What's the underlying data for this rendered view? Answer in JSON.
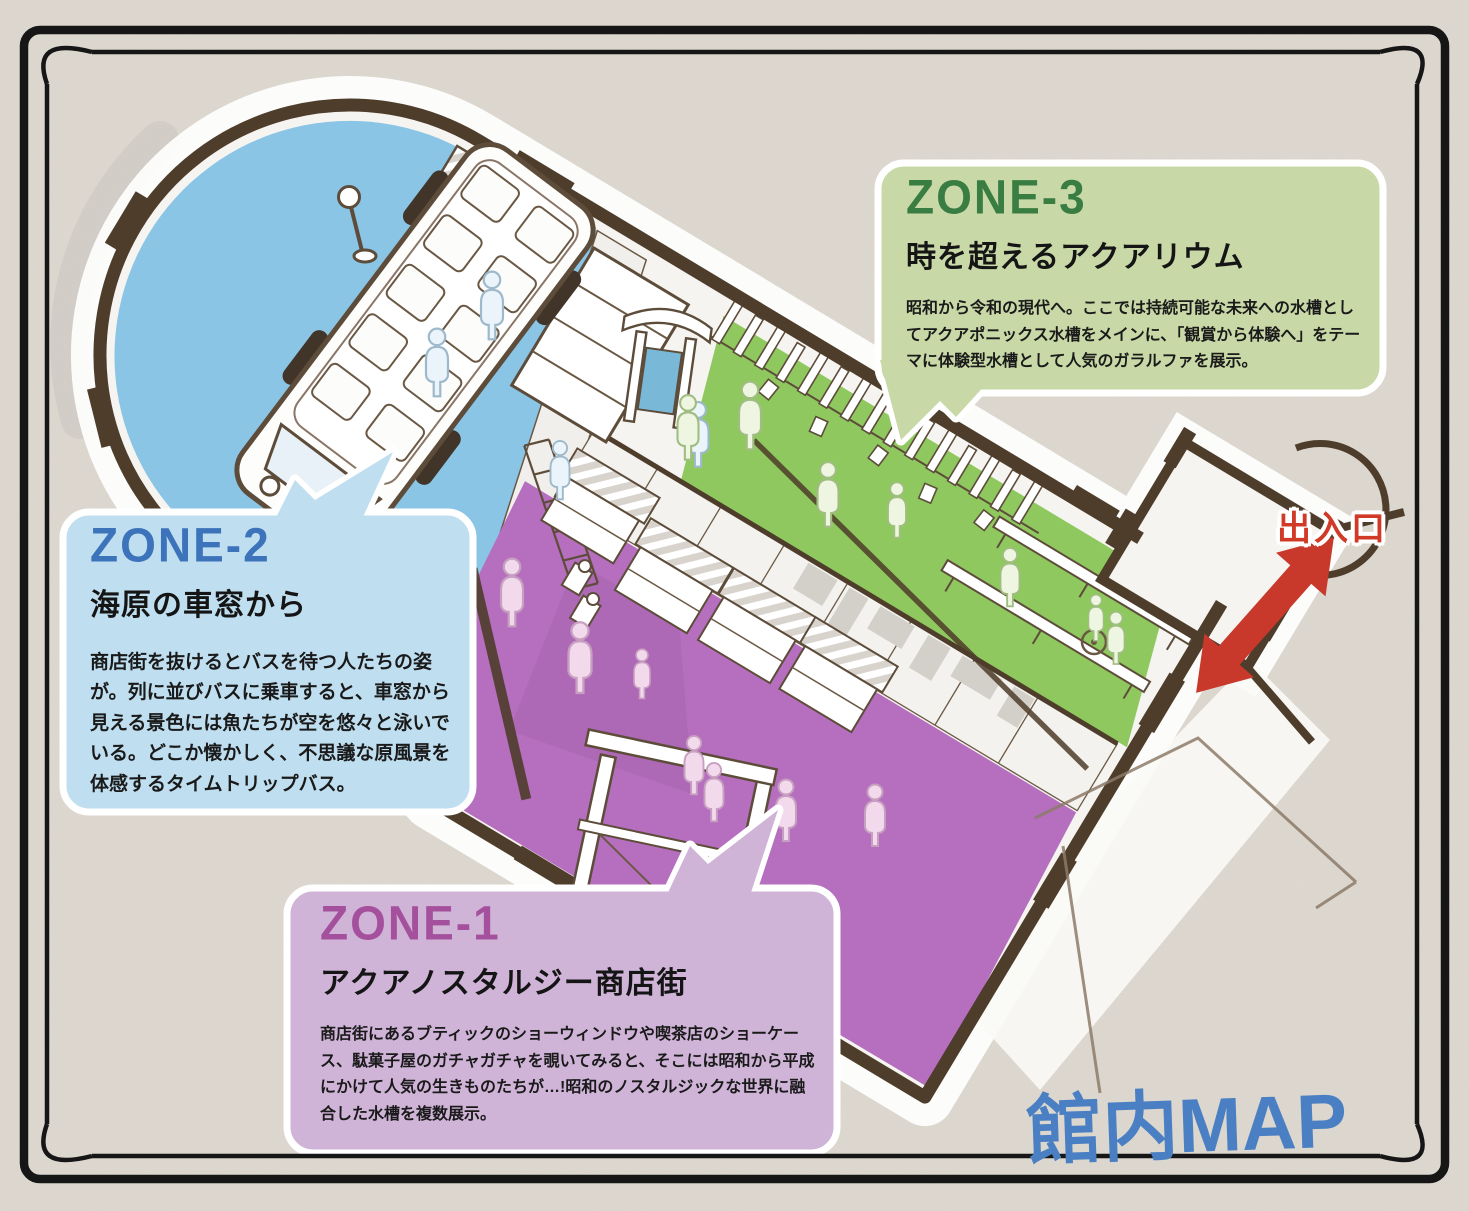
{
  "page": {
    "title_logo": "館内MAP",
    "logo_color": "#4a80c3",
    "background_color": "#ded9d1",
    "frame_color": "#161616"
  },
  "map": {
    "entrance_label": "出入口",
    "entrance_label_color": "#d03a26",
    "entrance_arrow_color": "#c8392b",
    "building_outline_color": "#4e3d2b",
    "floor_colors": {
      "zone1_purple": "#b56fbe",
      "zone2_blue": "#8ac5e6",
      "zone3_green": "#8ec85e"
    }
  },
  "zones": [
    {
      "id": "ZONE-1",
      "name": "アクアノスタルジー商店街",
      "description": "商店街にあるブティックのショーウィンドウや喫茶店のショーケース、駄菓子屋のガチャガチャを覗いてみると、そこには昭和から平成にかけて人気の生きものたちが…!昭和のノスタルジックな世界に融合した水槽を複数展示。",
      "title_color": "#a4509c",
      "bubble_color": "#cfb4d8"
    },
    {
      "id": "ZONE-2",
      "name": "海原の車窓から",
      "description": "商店街を抜けるとバスを待つ人たちの姿が。列に並びバスに乗車すると、車窓から見える景色には魚たちが空を悠々と泳いでいる。どこか懐かしく、不思議な原風景を体感するタイムトリップバス。",
      "title_color": "#3c73ba",
      "bubble_color": "#bfdff0"
    },
    {
      "id": "ZONE-3",
      "name": "時を超えるアクアリウム",
      "description": "昭和から令和の現代へ。ここでは持続可能な未来への水槽としてアクアポニックス水槽をメインに、「観賞から体験へ」をテーマに体験型水槽として人気のガラルファを展示。",
      "title_color": "#3a7d42",
      "bubble_color": "#c8d8a6"
    }
  ]
}
